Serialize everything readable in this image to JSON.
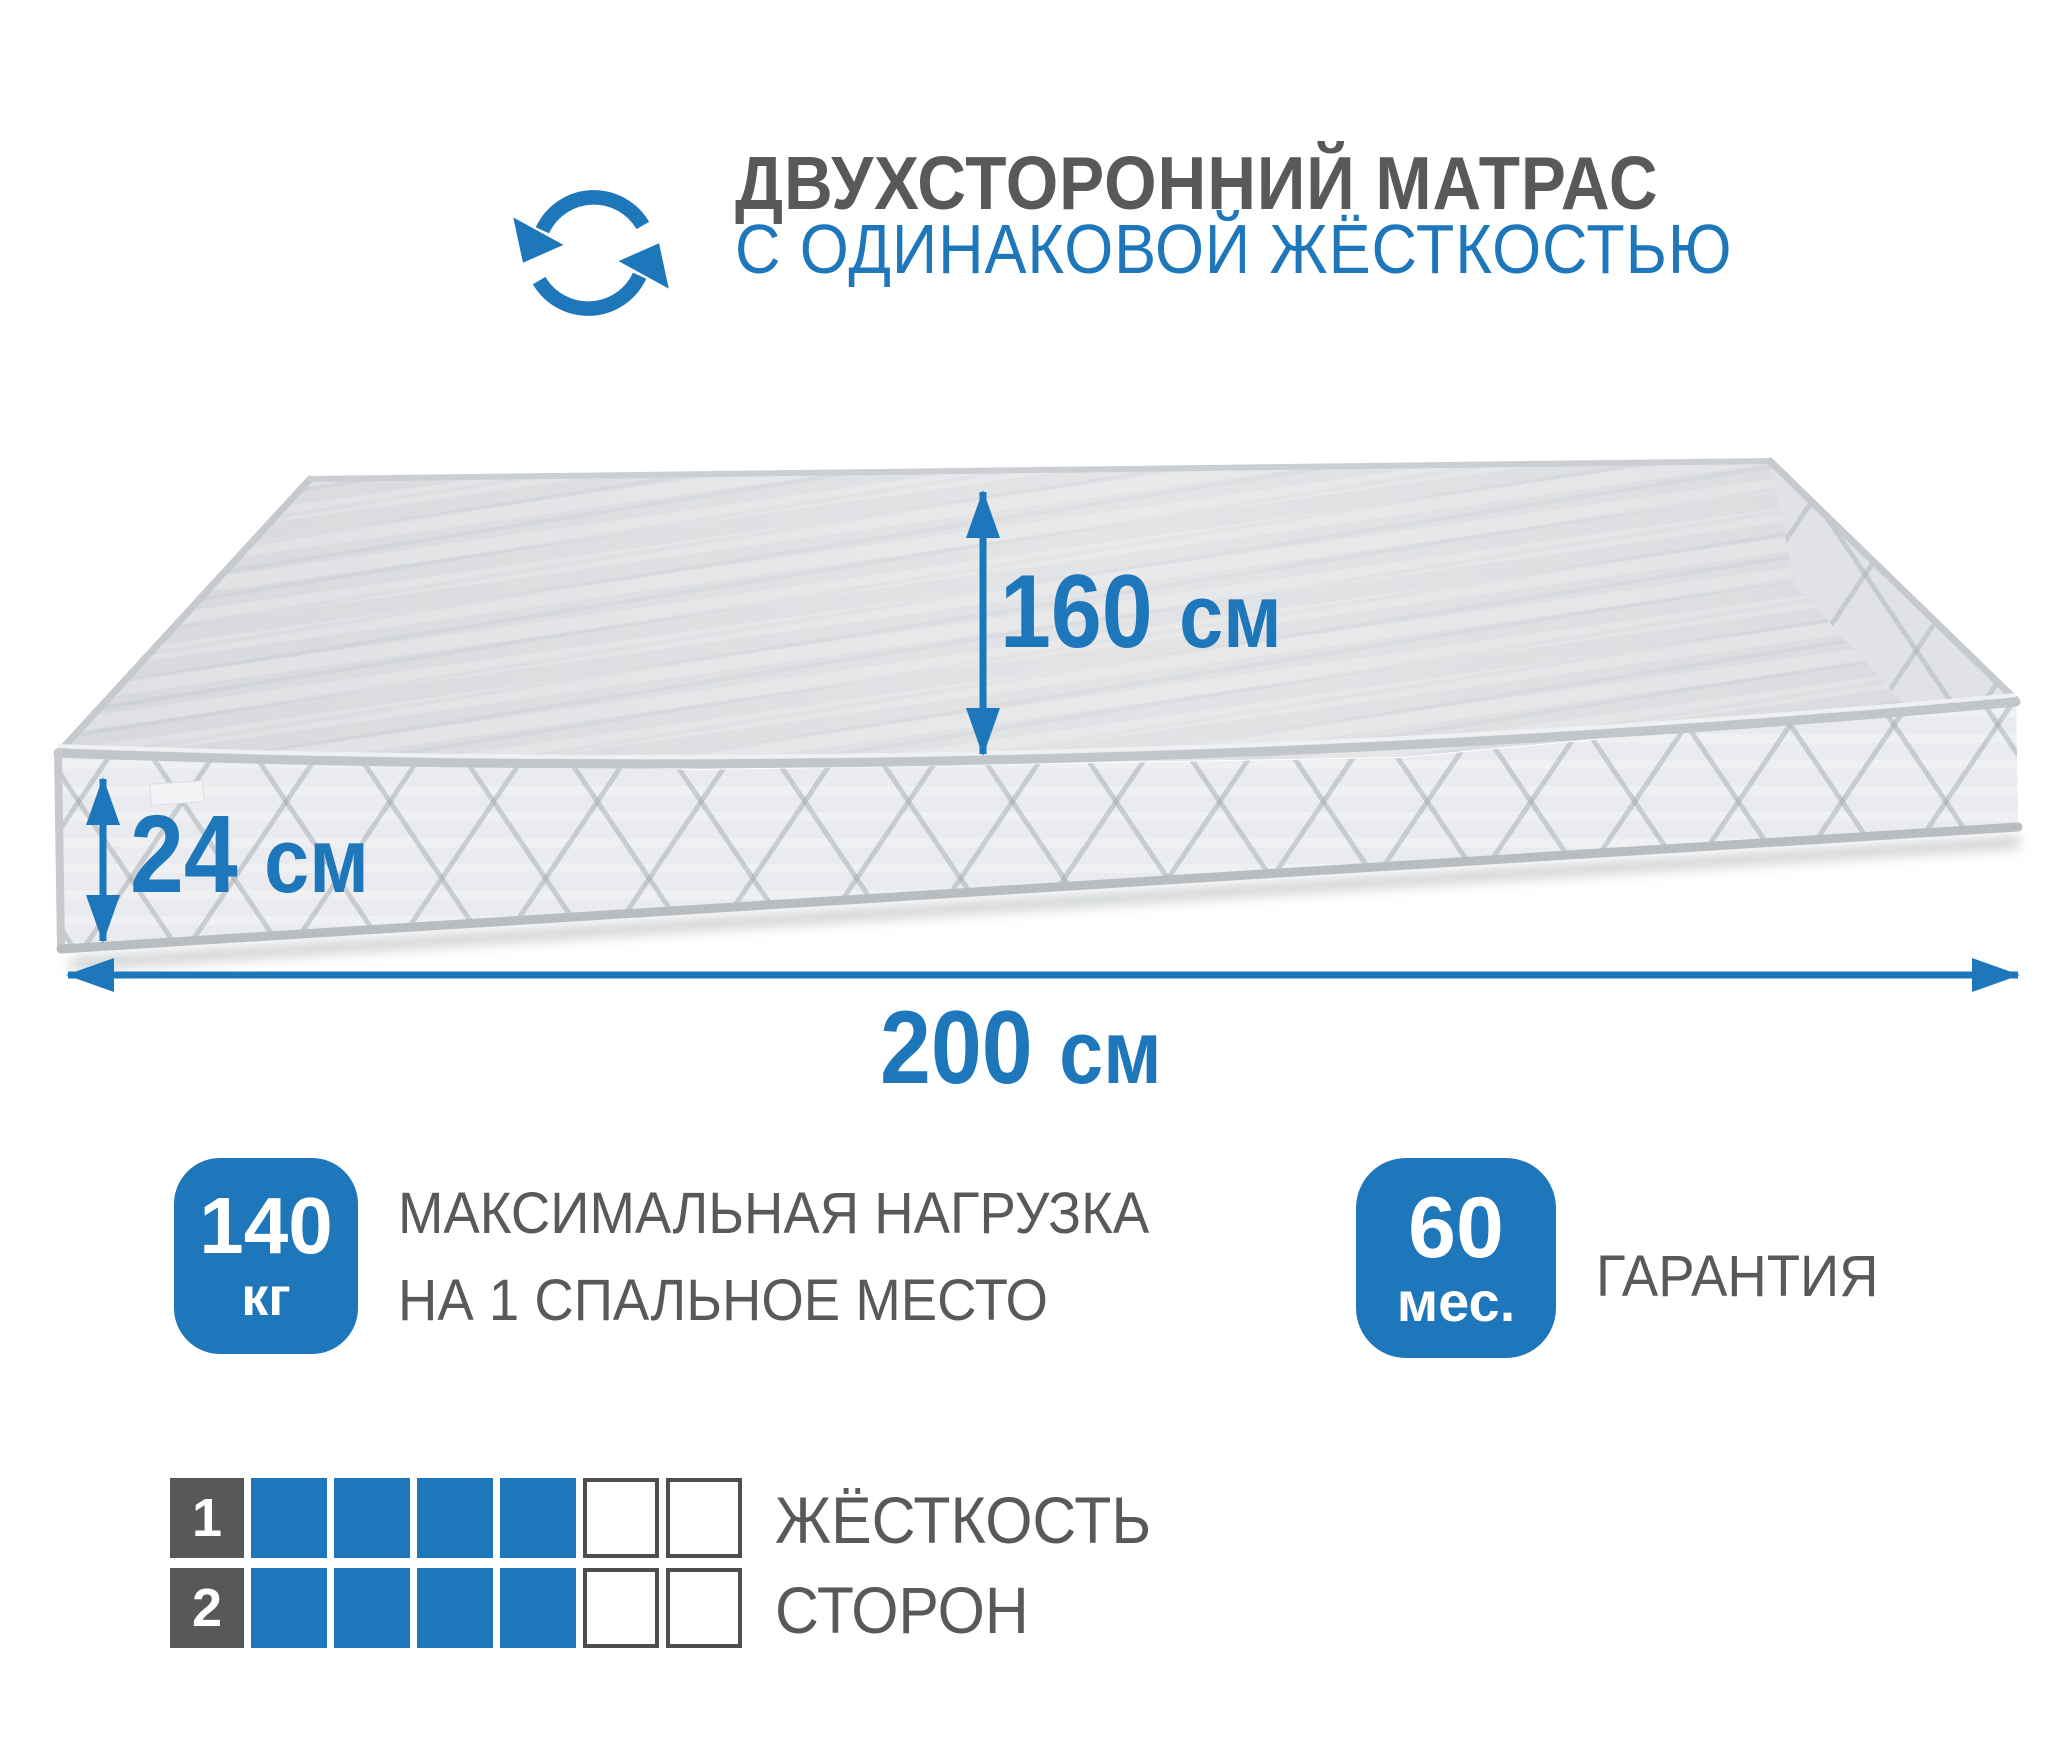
{
  "colors": {
    "accent_blue": "#1e76bb",
    "title_gray": "#58595b",
    "mattress_top": "#d7d9dc",
    "mattress_front": "#e9ebee"
  },
  "header": {
    "icon": "rotate-arrows-icon",
    "title_line1": "ДВУХСТОРОННИЙ МАТРАС",
    "title_line2": "С ОДИНАКОВОЙ ЖЁСТКОСТЬЮ"
  },
  "dimensions": {
    "top_width": {
      "value": "160",
      "unit": "см"
    },
    "thickness": {
      "value": "24",
      "unit": "см"
    },
    "length": {
      "value": "200",
      "unit": "см"
    }
  },
  "badges": {
    "max_load": {
      "value": "140",
      "unit": "кг",
      "label_line1": "МАКСИМАЛЬНАЯ НАГРУЗКА",
      "label_line2": "НА 1 СПАЛЬНОЕ МЕСТО"
    },
    "warranty": {
      "value": "60",
      "unit": "мес.",
      "label": "ГАРАНТИЯ"
    }
  },
  "firmness": {
    "caption_line1": "ЖЁСТКОСТЬ",
    "caption_line2": "СТОРОН",
    "scale_max": 6,
    "rows": [
      {
        "side": "1",
        "filled": 4
      },
      {
        "side": "2",
        "filled": 4
      }
    ]
  }
}
